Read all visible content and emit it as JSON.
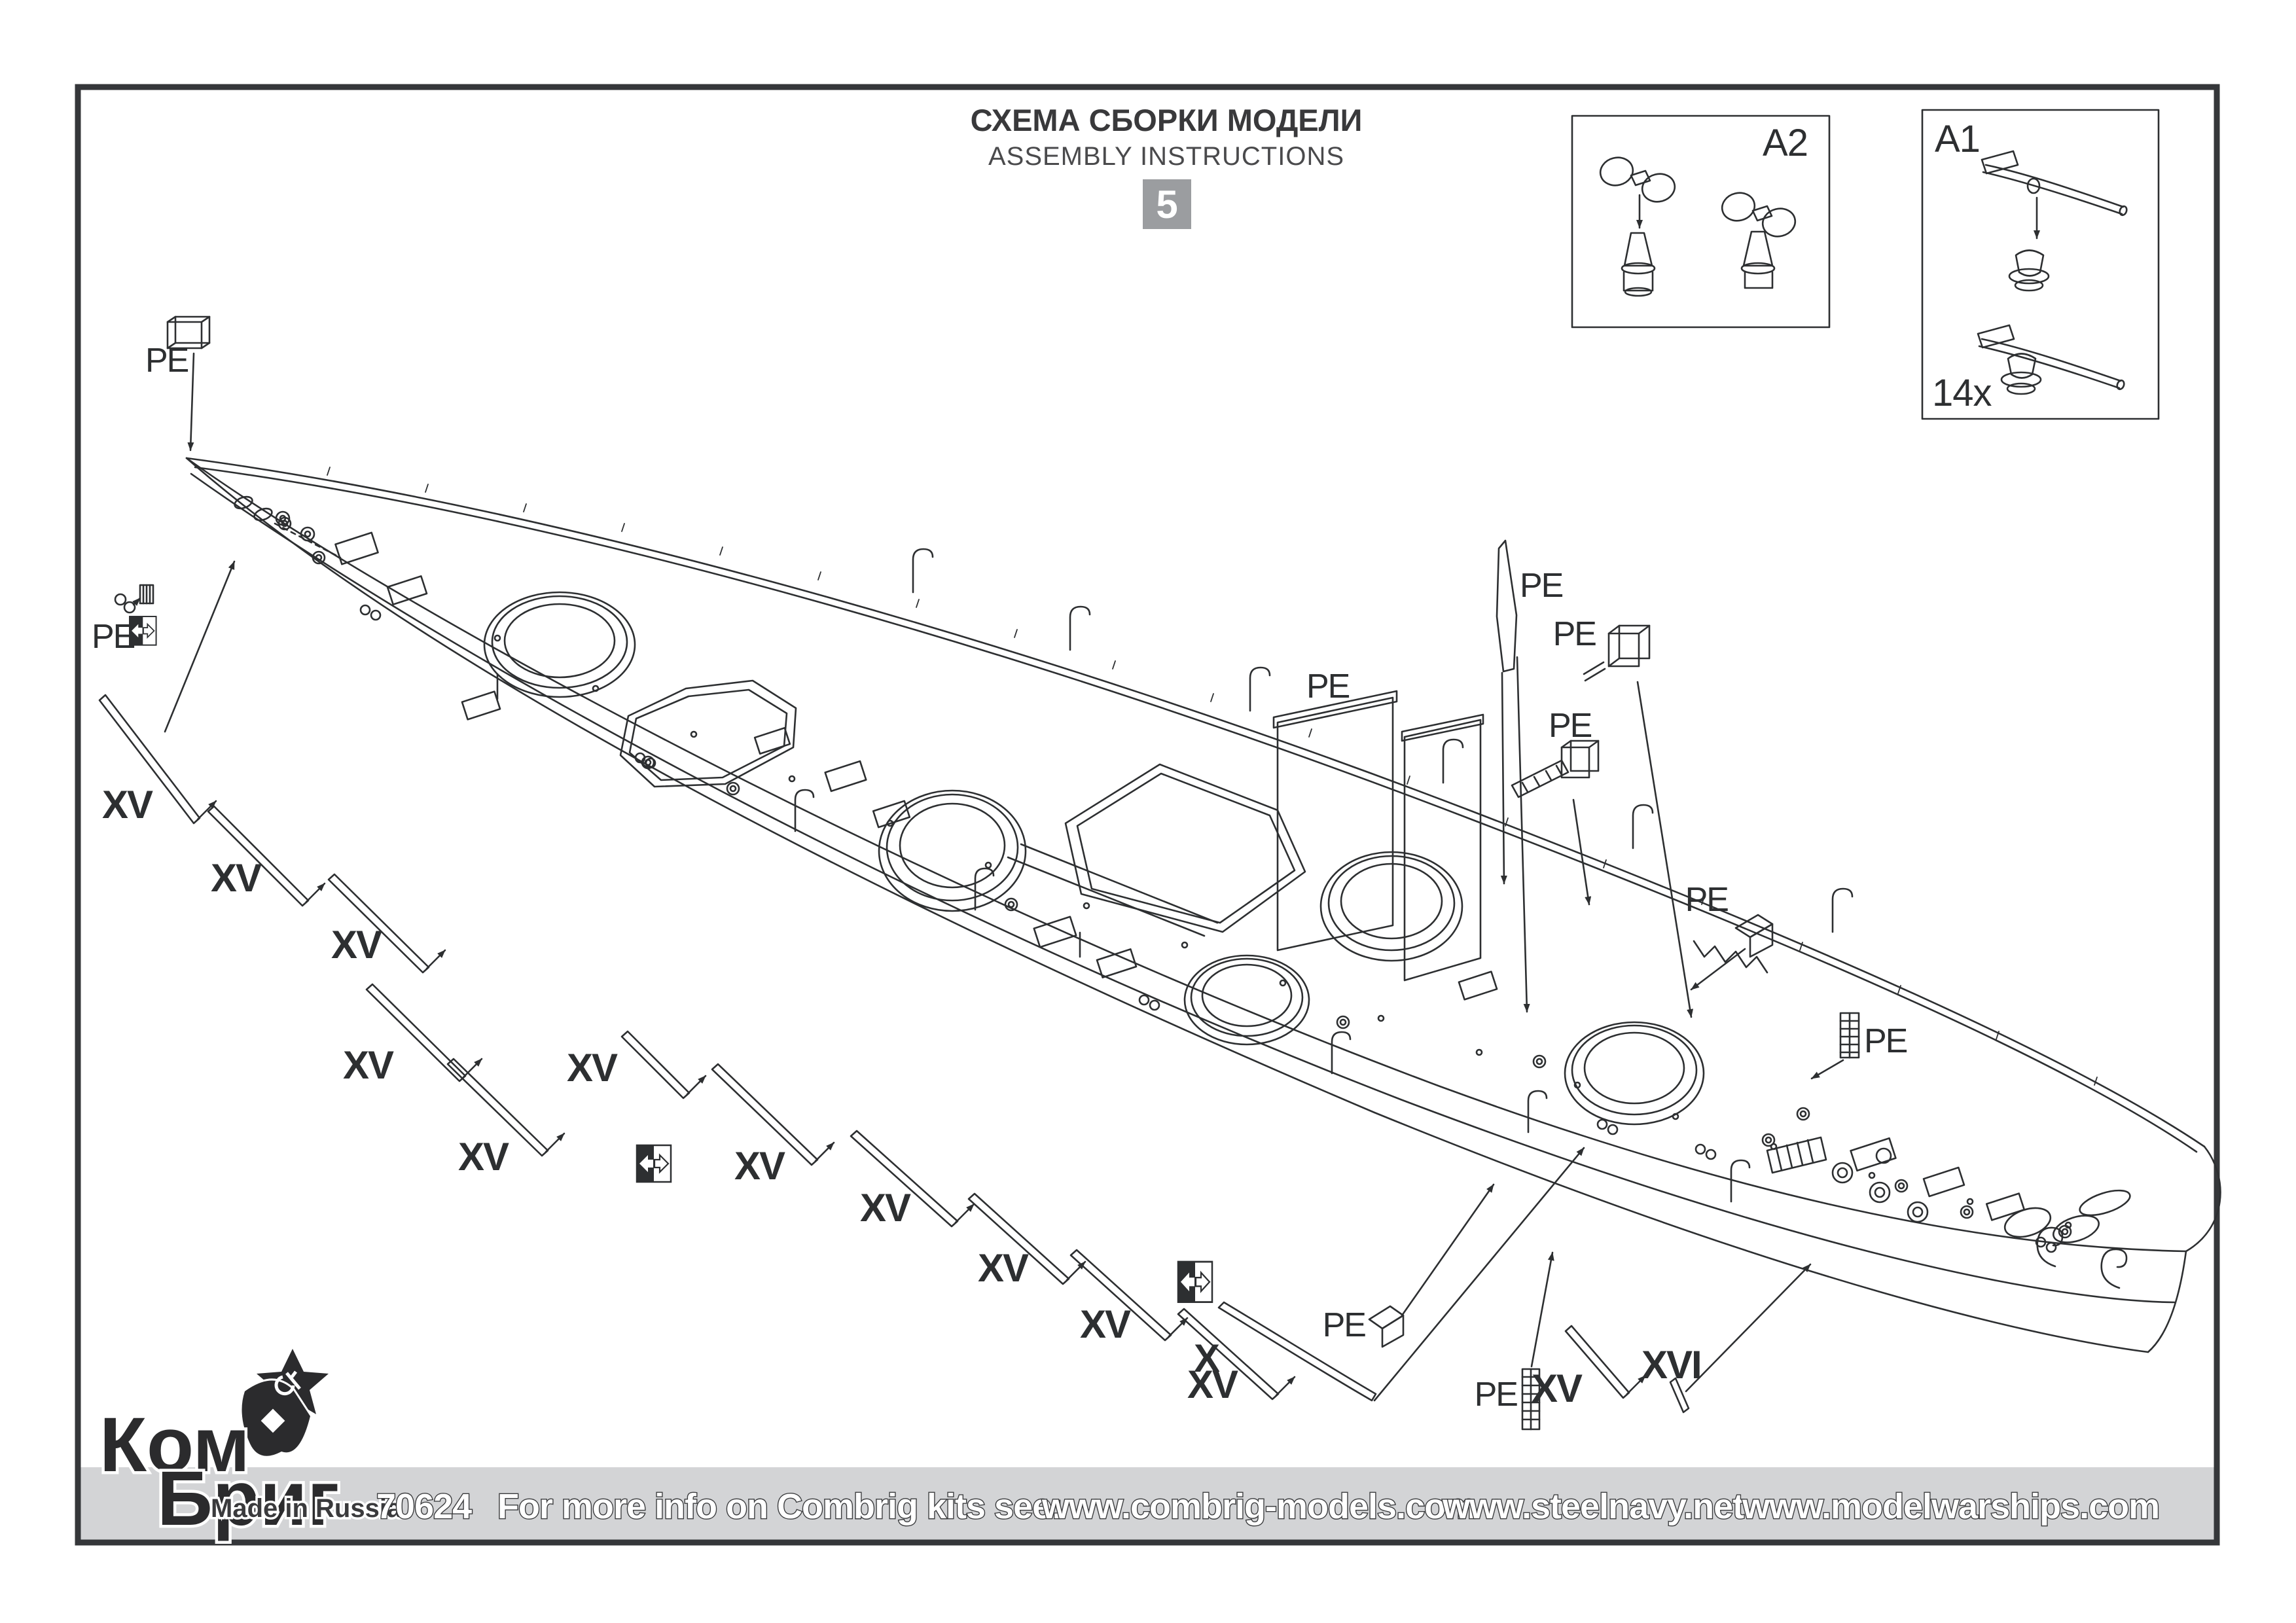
{
  "page": {
    "step_number": "5"
  },
  "title": {
    "ru": "СХЕМА СБОРКИ МОДЕЛИ",
    "en": "ASSEMBLY INSTRUCTIONS"
  },
  "detail_boxes": {
    "a2": {
      "label": "A2"
    },
    "a1": {
      "label": "A1",
      "quantity": "14x"
    }
  },
  "part_labels": {
    "pe": "PE",
    "xv": "XV",
    "x": "X",
    "xvi": "XVI"
  },
  "footer": {
    "kit_number": "70624",
    "info_text": "For more info on Combrig kits see:",
    "websites": [
      "www.combrig-models.com",
      "www.steelnavy.net",
      "www.modelwarships.com"
    ]
  },
  "logo": {
    "name_line1": "Ком",
    "name_line2": "Бриг",
    "tagline": "Made in Russia"
  },
  "colors": {
    "ink": "#2d2f31",
    "badge_bg": "#9b9da0",
    "footer_bar": "#d3d4d6",
    "paper": "#ffffff"
  }
}
